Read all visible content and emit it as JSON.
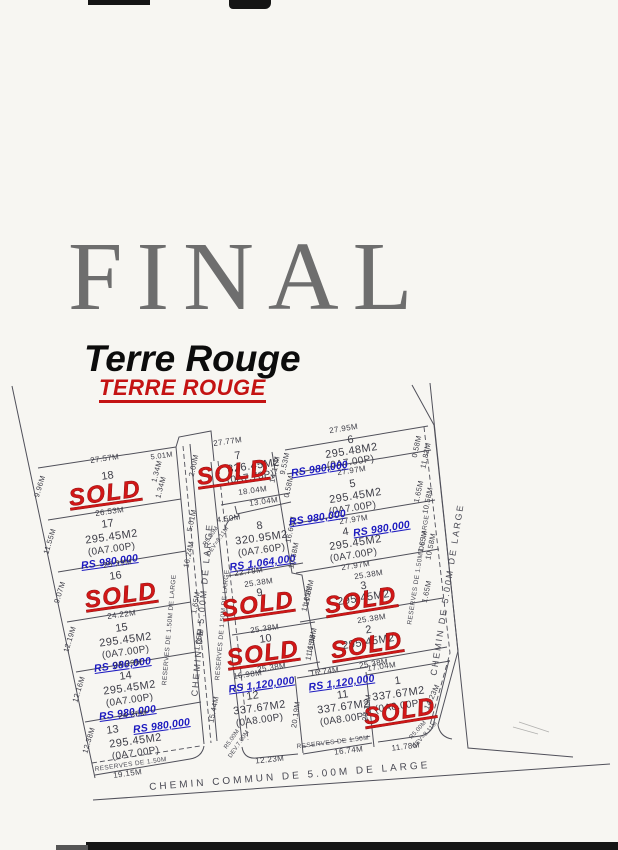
{
  "header": {
    "final": "FINAL",
    "title": "Terre Rouge",
    "subtitle": "TERRE ROUGE"
  },
  "labels": {
    "sold": "SOLD",
    "chemin_v": "CHEMIN DE 5.00M DE LARGE",
    "chemin_bottom": "CHEMIN COMMUN DE 5.00M DE LARGE",
    "reserve_long": "RESERVES DE 1.50M DE LARGE",
    "reserve_short": "RESERVES DE 1.50M"
  },
  "ticks": {
    "t200": "2.00M",
    "t501": "5.01M",
    "t134": "1.34M",
    "t165": "1.65M",
    "t058": "0.58M"
  },
  "colors": {
    "sold_red": "#d21717",
    "price_blue": "#1d1bc0",
    "title_red": "#c41313",
    "ink": "#3d3d47"
  },
  "lots": [
    {
      "num": "1",
      "area": "337.67M2",
      "perche": "(0A8.00P)",
      "sold": true,
      "top": "17.04M",
      "left": "20.19M",
      "right": "14.23M",
      "bottom": "11.78M",
      "corner_r": "R5.00M",
      "corner_dev": "DEV=8.11M"
    },
    {
      "num": "2",
      "area": "295.45M2",
      "sold": true,
      "top": "25.38M",
      "left": "11.65M",
      "bottom": "25.38M"
    },
    {
      "num": "3",
      "area": "295.45M2",
      "sold": true,
      "top": "25.38M",
      "left": "11.65M"
    },
    {
      "num": "4",
      "area": "295.45M2",
      "perche": "(0A7.00P)",
      "price": "RS 980,000",
      "top": "27.97M",
      "right": "10.58M",
      "bottom": "27.97M"
    },
    {
      "num": "5",
      "area": "295.45M2",
      "perche": "(0A7.00P)",
      "price": "RS 980,000",
      "top": "27.97M",
      "right": "10.58M"
    },
    {
      "num": "6",
      "area": "295.48M2",
      "perche": "(0A7.00P)",
      "price": "RS 980,000",
      "top": "27.95M",
      "right": "11.82M"
    },
    {
      "num": "7",
      "area": "326.45M2",
      "perche": "(0A7.73P)",
      "sold": true,
      "top": "27.77M",
      "right_upper": "14.17M",
      "right_lower": "9.53M",
      "bottom": "18.04M",
      "bottom2": "13.04M"
    },
    {
      "num": "8",
      "area": "320.95M2",
      "perche": "(0A7.60P)",
      "price": "RS 1,064,000",
      "top": "4.50M",
      "top2": "5.01M",
      "left": "16.24M",
      "right_upper": "16.61M",
      "right_lower": "10.58M",
      "right_jog": "0.58M",
      "bottom": "22.79M",
      "corner_r": "R5.00M",
      "corner_dev": "DEV=8.11M"
    },
    {
      "num": "9",
      "sold": true,
      "top": "25.38M",
      "right": "11.65M"
    },
    {
      "num": "10",
      "sold": true,
      "top": "25.38M",
      "right": "11.65M",
      "bottom": "25.38M"
    },
    {
      "num": "11",
      "area": "337.67M2",
      "perche": "(0A8.00P)",
      "price": "RS 1,120,000",
      "top": "16.74M",
      "left": "20.19M",
      "bottom": "16.74M"
    },
    {
      "num": "12",
      "area": "337.67M2",
      "perche": "(0A8.00P)",
      "price": "RS 1,120,000",
      "top": "16.98M",
      "left": "15.44M",
      "bottom": "12.23M",
      "corner_r": "R5.00M",
      "corner_dev": "DEV.7.60M"
    },
    {
      "num": "13",
      "area": "295.45M2",
      "perche": "(0A7.00P)",
      "price": "RS 980,000",
      "top": "24.35M",
      "left": "12.38M",
      "bottom": "19.15M"
    },
    {
      "num": "14",
      "area": "295.45M2",
      "perche": "(0A7.00P)",
      "price": "RS 980,000",
      "top": "24.29M",
      "left": "12.16M"
    },
    {
      "num": "15",
      "area": "295.45M2",
      "perche": "(0A7.00P)",
      "price": "RS 980,000",
      "top": "24.22M",
      "left": "12.19M"
    },
    {
      "num": "16",
      "sold": true,
      "top": "25.29M",
      "left": "9.07M",
      "bottom": "24.22M"
    },
    {
      "num": "17",
      "area": "295.45M2",
      "perche": "(0A7.00P)",
      "price": "RS 980,000",
      "top": "26.53M",
      "left": "11.55M"
    },
    {
      "num": "18",
      "sold": true,
      "top": "27.57M",
      "left": "9.96M"
    }
  ]
}
